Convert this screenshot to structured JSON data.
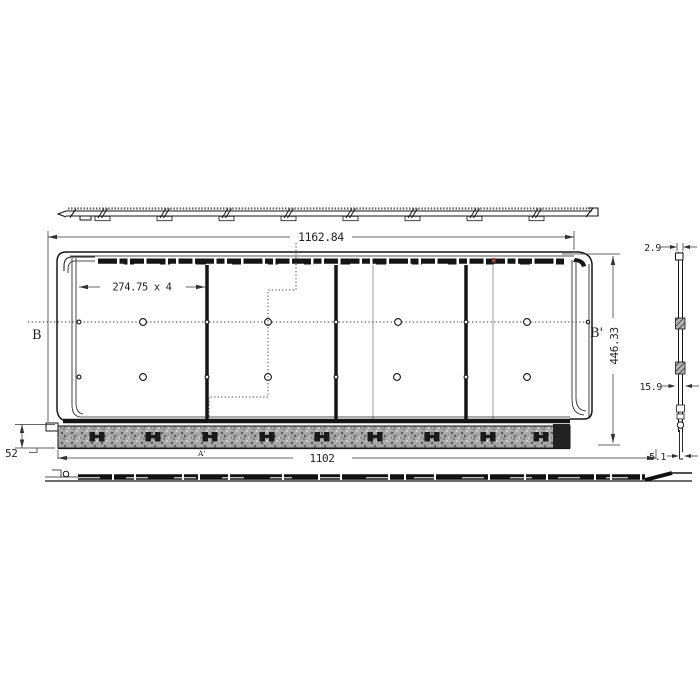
{
  "dims": {
    "overall_width": "1162.84",
    "pitch": "274.75 x 4",
    "overall_height": "446.33",
    "bottom_width": "1102",
    "edge_height": "52",
    "side_top": "2.9",
    "side_mid": "15.9",
    "side_bottom": "5.1"
  },
  "labels": {
    "b": "B",
    "b_prime": "B'",
    "a_prime": "A'"
  },
  "colors": {
    "line": "#161616",
    "dim": "#333333",
    "accent_red": "#9b4434",
    "speckle_base": "#a9a9a9"
  }
}
